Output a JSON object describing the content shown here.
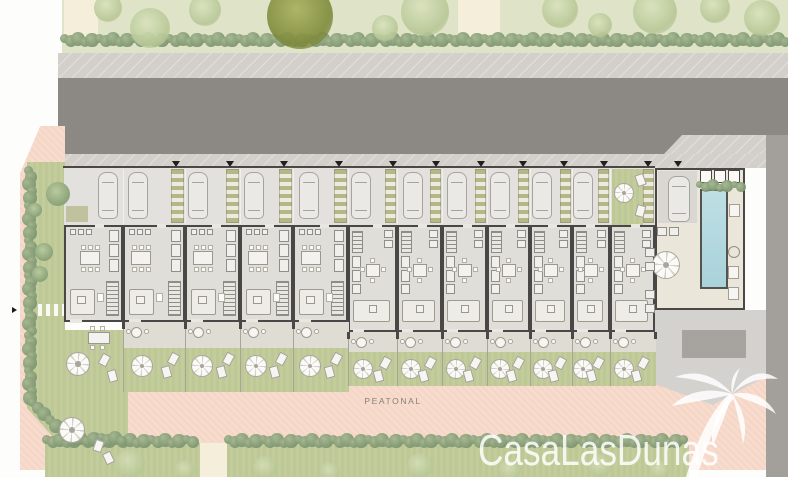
{
  "meta": {
    "type": "architectural-site-plan",
    "project": "Casa Las Dunas"
  },
  "labels": {
    "peatonal": "PEATONAL"
  },
  "branding": {
    "logo_text": "CasaLasDunas",
    "palm_icon": "palm-tree-icon",
    "logo_color": "#ffffff"
  },
  "colors": {
    "bg": "#fdfdfb",
    "grass": "#dfe4c9",
    "path": "#f4eedb",
    "sidewalk": "#d3d0cb",
    "road": "#8c8985",
    "pink": "#f7dcce",
    "parking": "#e3e1dd",
    "floor": "#e0ded9",
    "wall": "#4a4846",
    "cream": "#eae6d9",
    "pool": "#b2d7dd",
    "lawn": "#c3cc9b",
    "terrace": "#dfdcd4",
    "pergola_green": "#b4b788",
    "pergola_light": "#edebe0",
    "paving": "#d4d2ce",
    "paving_dark": "#a7a4a0",
    "strip_gray": "#a3a09c",
    "furniture_line": "#9a978f",
    "label": "#8b8076"
  },
  "site": {
    "units": [
      {
        "id": 1,
        "type": "end",
        "x": 64,
        "w": 59,
        "car_x": 98,
        "planter": true
      },
      {
        "id": 2,
        "type": "wide",
        "x": 123,
        "w": 62,
        "car_x": 128
      },
      {
        "id": 3,
        "type": "wide",
        "x": 185,
        "w": 55,
        "car_x": 188
      },
      {
        "id": 4,
        "type": "wide",
        "x": 240,
        "w": 53,
        "car_x": 244
      },
      {
        "id": 5,
        "type": "wide",
        "x": 293,
        "w": 55,
        "car_x": 299
      },
      {
        "id": 6,
        "type": "narrow",
        "x": 348,
        "w": 49,
        "car_x": 351
      },
      {
        "id": 7,
        "type": "narrow",
        "x": 397,
        "w": 45,
        "car_x": 403
      },
      {
        "id": 8,
        "type": "narrow",
        "x": 442,
        "w": 45,
        "car_x": 447
      },
      {
        "id": 9,
        "type": "narrow",
        "x": 487,
        "w": 43,
        "car_x": 490
      },
      {
        "id": 10,
        "type": "narrow",
        "x": 530,
        "w": 42,
        "car_x": 532
      },
      {
        "id": 11,
        "type": "narrow",
        "x": 572,
        "w": 38,
        "car_x": 573
      },
      {
        "id": 12,
        "type": "narrow",
        "x": 610,
        "w": 45,
        "top_garden": true
      }
    ],
    "hedges": [
      {
        "x": 64,
        "y": 40,
        "len": 724
      },
      {
        "x": 46,
        "y": 441,
        "len": 152
      },
      {
        "x": 228,
        "y": 441,
        "len": 460
      },
      {
        "x": 30,
        "y": 170,
        "len": 165,
        "vertical": true
      },
      {
        "x": 30,
        "y": 335,
        "len": 66,
        "vertical": true
      },
      {
        "x": 32,
        "y": 402,
        "len": 40,
        "diag": true
      },
      {
        "x": 66,
        "y": 439,
        "len": 58
      },
      {
        "x": 699,
        "y": 186,
        "len": 42,
        "small": true
      }
    ],
    "top_trees": [
      {
        "cx": 300,
        "cy": 16,
        "r": 33,
        "variant": "olive"
      },
      {
        "cx": 108,
        "cy": 8,
        "r": 14,
        "variant": "light"
      },
      {
        "cx": 150,
        "cy": 28,
        "r": 20,
        "variant": "light"
      },
      {
        "cx": 205,
        "cy": 10,
        "r": 16,
        "variant": "light"
      },
      {
        "cx": 385,
        "cy": 28,
        "r": 13,
        "variant": "light"
      },
      {
        "cx": 425,
        "cy": 12,
        "r": 24,
        "variant": "light"
      },
      {
        "cx": 560,
        "cy": 10,
        "r": 18,
        "variant": "light"
      },
      {
        "cx": 600,
        "cy": 25,
        "r": 12,
        "variant": "light"
      },
      {
        "cx": 655,
        "cy": 12,
        "r": 22,
        "variant": "light"
      },
      {
        "cx": 715,
        "cy": 8,
        "r": 15,
        "variant": "light"
      },
      {
        "cx": 762,
        "cy": 18,
        "r": 18,
        "variant": "light"
      }
    ],
    "bottom_trees": [
      {
        "cx": 130,
        "cy": 464,
        "r": 15
      },
      {
        "cx": 185,
        "cy": 470,
        "r": 10
      },
      {
        "cx": 265,
        "cy": 468,
        "r": 12
      },
      {
        "cx": 330,
        "cy": 472,
        "r": 10
      },
      {
        "cx": 420,
        "cy": 466,
        "r": 13
      },
      {
        "cx": 510,
        "cy": 470,
        "r": 11
      },
      {
        "cx": 600,
        "cy": 466,
        "r": 12
      },
      {
        "cx": 660,
        "cy": 470,
        "r": 10
      }
    ],
    "end_garden": {
      "trees": [
        {
          "cx": 58,
          "cy": 194,
          "r": 12
        },
        {
          "cx": 44,
          "cy": 252,
          "r": 9
        },
        {
          "cx": 40,
          "cy": 274,
          "r": 8
        },
        {
          "cx": 35,
          "cy": 210,
          "r": 7
        }
      ],
      "table": {
        "x": 88,
        "y": 332,
        "w": 22,
        "h": 12
      },
      "parasols": [
        {
          "cx": 78,
          "cy": 364,
          "r": 12
        },
        {
          "cx": 72,
          "cy": 430,
          "r": 13
        }
      ],
      "loungers": [
        {
          "x": 100,
          "y": 354,
          "rot": 28
        },
        {
          "x": 108,
          "y": 370,
          "rot": -15
        },
        {
          "x": 94,
          "y": 440,
          "rot": 20
        },
        {
          "x": 104,
          "y": 452,
          "rot": -25
        }
      ],
      "stepping_path": {
        "x": 38,
        "y": 304,
        "w": 26,
        "h": 12
      },
      "planter": {
        "x": 66,
        "y": 206,
        "w": 22,
        "h": 16
      }
    },
    "communal": {
      "car": {
        "x": 668,
        "y": 176
      },
      "loungers": [
        {
          "x": 729,
          "y": 204
        },
        {
          "x": 728,
          "y": 266
        },
        {
          "x": 728,
          "y": 287
        }
      ],
      "round_table": {
        "cx": 666,
        "cy": 265,
        "r": 14
      },
      "seats": [
        {
          "x": 657,
          "y": 227
        },
        {
          "x": 669,
          "y": 227
        },
        {
          "x": 645,
          "y": 248
        },
        {
          "x": 645,
          "y": 262
        },
        {
          "x": 645,
          "y": 290
        },
        {
          "x": 645,
          "y": 304
        }
      ],
      "ring": {
        "cx": 733,
        "cy": 251,
        "r": 5
      }
    },
    "parking_triangles": [
      176,
      230,
      284,
      339,
      393,
      436,
      481,
      523,
      564,
      604,
      648,
      678
    ]
  }
}
